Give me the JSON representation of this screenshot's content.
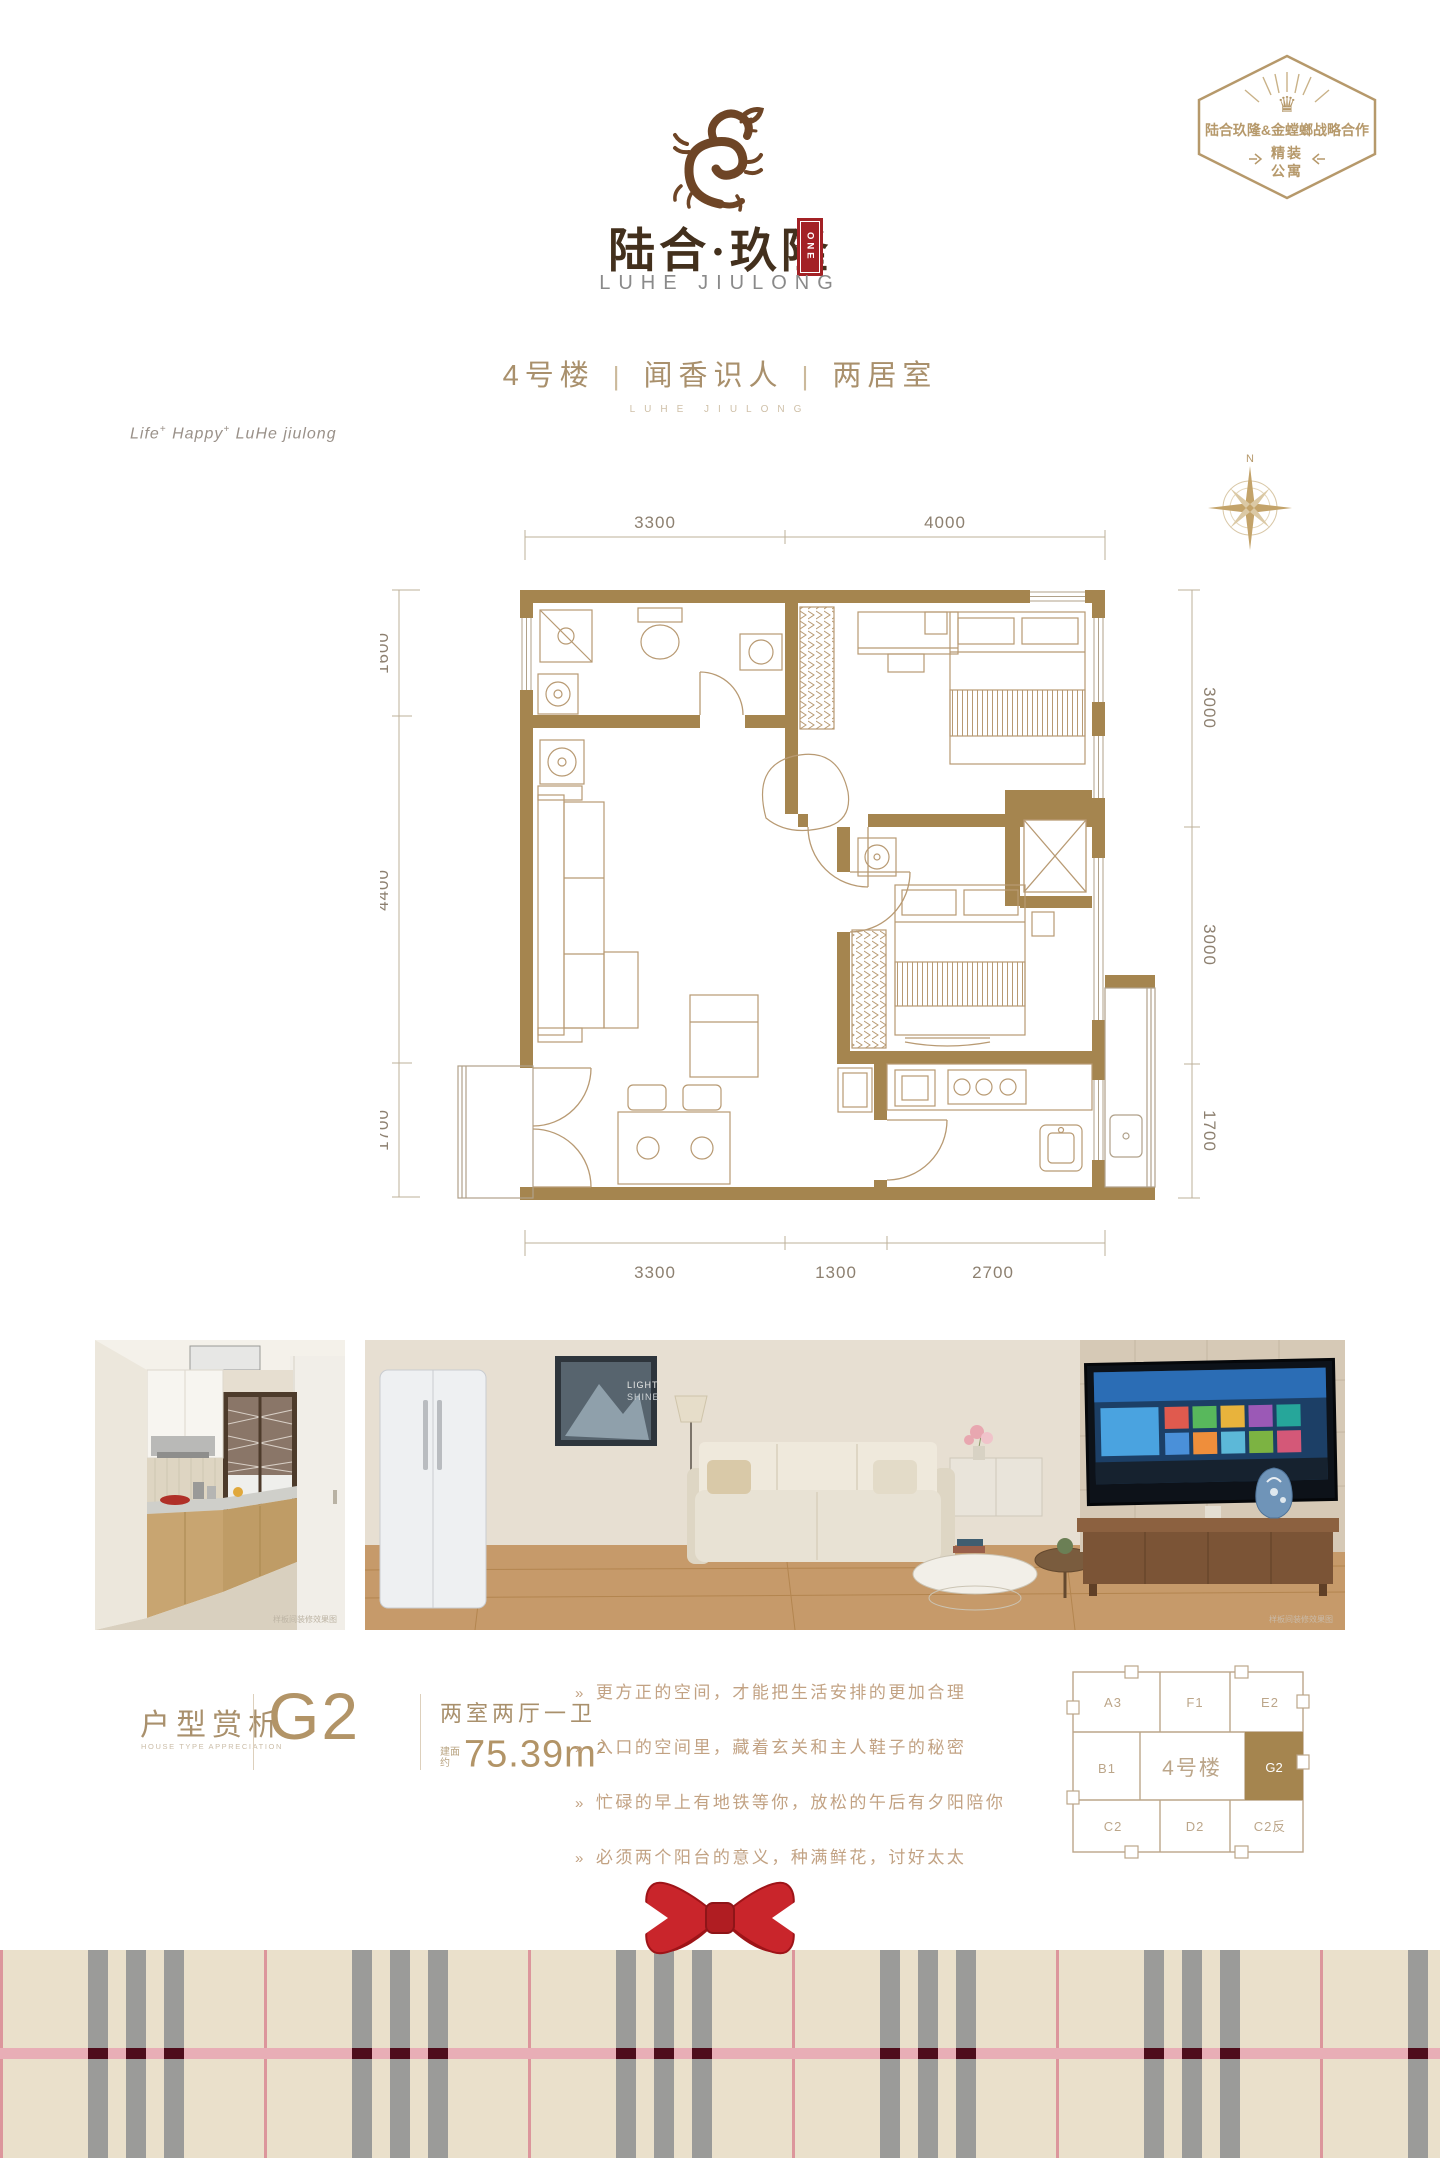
{
  "brand": {
    "name_cn": "陆合·玖隆",
    "name_en": "LUHE JIULONG",
    "seal": "ONE"
  },
  "corner_badge": {
    "line": "陆合玖隆&金螳螂战略合作",
    "tag_top": "精装",
    "tag_bottom": "公寓"
  },
  "header": {
    "building": "4号楼",
    "divider": "|",
    "slogan": "闻香识人",
    "rooms": "两居室",
    "sub_en": "LUHE JIULONG"
  },
  "tagline": {
    "w1": "Life",
    "w2": "Happy",
    "w3": "LuHe jiulong",
    "sup": "+"
  },
  "floorplan": {
    "north": "N",
    "dims": {
      "top": [
        "3300",
        "4000"
      ],
      "left": [
        "1600",
        "4400",
        "1700"
      ],
      "right": [
        "3000",
        "3000",
        "1700"
      ],
      "bottom": [
        "3300",
        "1300",
        "2700"
      ]
    }
  },
  "photos": {
    "kitchen": {
      "watermark": "样板间装修效果图"
    },
    "living": {
      "watermark": "样板间装修效果图",
      "art_line1": "LIGHT",
      "art_line2": "SHINE"
    }
  },
  "details": {
    "section_cn": "户型赏析",
    "section_en": "HOUSE TYPE APPRECIATION",
    "unit": "G2",
    "layout": "两室两厅一卫",
    "area_prefix_top": "建面",
    "area_prefix_bottom": "约",
    "area_value": "75.39",
    "area_sup": "2",
    "marker": "»",
    "bullets": [
      "更方正的空间，才能把生活安排的更加合理",
      "入口的空间里，藏着玄关和主人鞋子的秘密",
      "忙碌的早上有地铁等你，放松的午后有夕阳陪你",
      "必须两个阳台的意义，种满鲜花，讨好太太"
    ]
  },
  "keyplan": {
    "center": "4号楼",
    "a3": "A3",
    "f1": "F1",
    "e2": "E2",
    "b1": "B1",
    "g2": "G2",
    "c2": "C2",
    "d2": "D2",
    "c2r": "C2反"
  },
  "colors": {
    "wall_brown": "#a5854f",
    "furniture_line": "#b89a73",
    "dim_text": "#8d8070",
    "accent_red": "#a32125",
    "badge_gold": "#b6996b",
    "plaid_base": "#eae0cb",
    "plaid_gray": "#9b9b99",
    "plaid_pink": "#e8aeb6",
    "plaid_maroon": "#4f0d1c",
    "bow_red": "#c9252b"
  }
}
